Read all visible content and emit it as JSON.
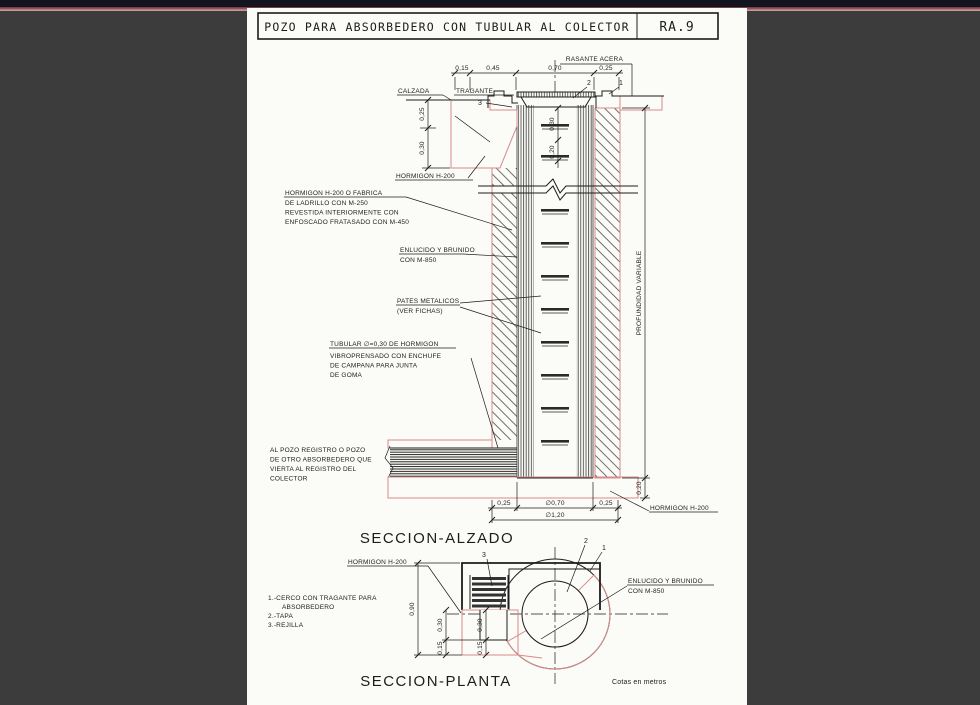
{
  "colors": {
    "paper": "#fbfbf7",
    "background": "#3c3c3c",
    "linework": "#1c1c1c",
    "concrete_outline": "#d98b8b",
    "topbar": "#14141f"
  },
  "titlebar": {
    "title": "POZO PARA ABSORBEDERO CON TUBULAR AL COLECTOR",
    "sheet": "RA.9"
  },
  "elevation": {
    "label": "SECCION-ALZADO",
    "rasante_acera": "RASANTE ACERA",
    "calzada": "CALZADA",
    "tragante": "TRAGANTE",
    "marks": {
      "m1": "1",
      "m2": "2",
      "m3": "3"
    },
    "dims_top": [
      "0,15",
      "0,45",
      "0,70",
      "0,25"
    ],
    "dims_left": [
      "0,25",
      "0,30"
    ],
    "dims_rungs": [
      "0,30",
      "0,20"
    ],
    "dims_bottom": [
      "0,25",
      "∅0,70",
      "0,25"
    ],
    "dim_total": "∅1,20",
    "dim_base": "0,20",
    "profundidad": "PROFUNDIDAD VARIABLE",
    "hormigon_curb": "HORMIGON H-200",
    "hormigon_base": "HORMIGON H-200",
    "wall_note": [
      "HORMIGON H-200 O FABRICA",
      "DE LADRILLO CON M-250",
      "REVESTIDA INTERIORMENTE CON",
      "ENFOSCADO FRATASADO CON M-450"
    ],
    "enlucido_note": [
      "ENLUCIDO Y BRUNIDO",
      "CON M-850"
    ],
    "pates_note": [
      "PATES METALICOS",
      "(VER FICHAS)"
    ],
    "tubular_note": [
      "TUBULAR ∅=0,30 DE HORMIGON",
      "VIBROPRENSADO CON ENCHUFE",
      "DE CAMPANA PARA JUNTA",
      "DE GOMA"
    ],
    "colector_note": [
      "AL POZO REGISTRO O POZO",
      "DE OTRO ABSORBEDERO QUE",
      "VIERTA AL REGISTRO DEL",
      "COLECTOR"
    ]
  },
  "plan": {
    "label": "SECCION-PLANTA",
    "hormigon": "HORMIGON H-200",
    "enlucido_note": [
      "ENLUCIDO Y BRUNIDO",
      "CON M-850"
    ],
    "marks": {
      "m1": "1",
      "m2": "2",
      "m3": "3"
    },
    "dims": {
      "height": "0,90",
      "d30a": "0,30",
      "d15a": "0,15",
      "d30b": "0,30",
      "d15b": "0,15"
    },
    "legend": [
      "1.-CERCO CON TRAGANTE PARA",
      "ABSORBEDERO",
      "2.-TAPA",
      "3.-REJILLA"
    ],
    "units": "Cotas en metros"
  }
}
